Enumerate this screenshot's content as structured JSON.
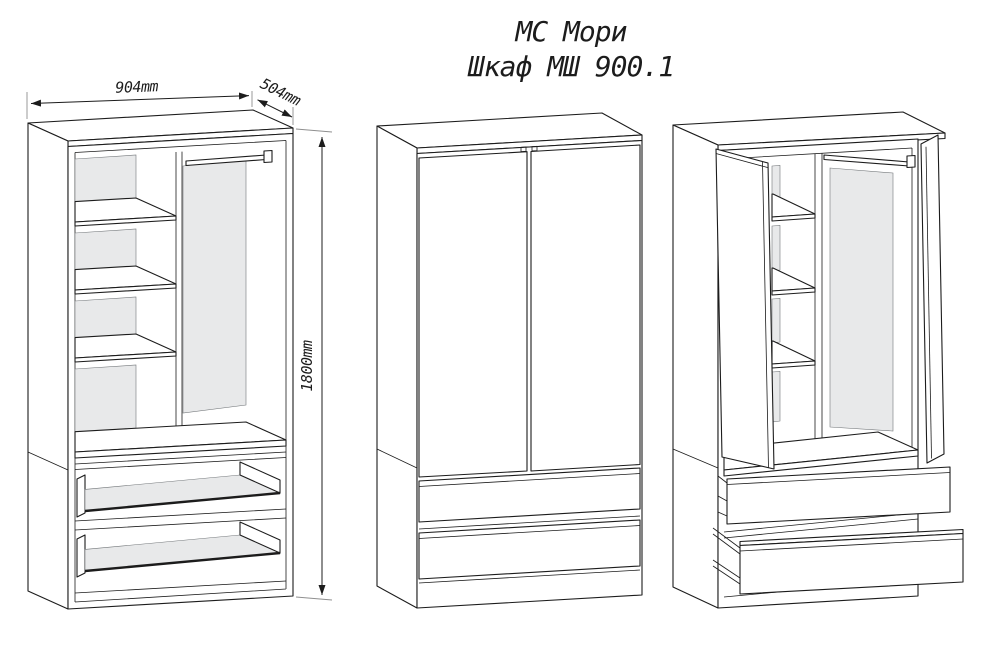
{
  "title": {
    "line1": "МС Мори",
    "line2": "Шкаф МШ 900.1"
  },
  "dims": {
    "width": "904mm",
    "depth": "504mm",
    "height": "1800mm"
  },
  "colors": {
    "line": "#1c1c1c",
    "panel_fill": "#e8e9ea",
    "extension_line": "#8f8f8f",
    "background": "#ffffff"
  }
}
